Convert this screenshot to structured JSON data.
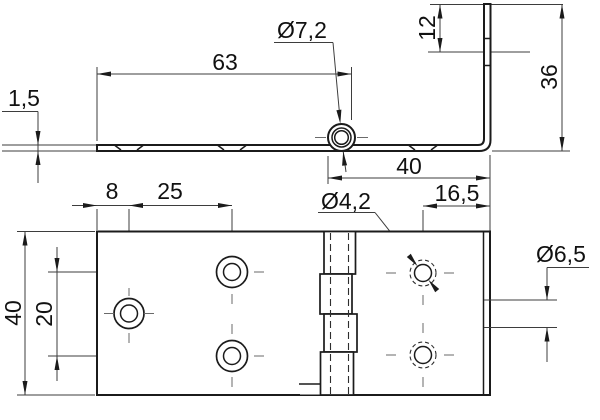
{
  "drawing": {
    "type": "technical-drawing",
    "part": "bent hinge, two views (side profile and plan view)",
    "units_style": "comma decimal",
    "labels": {
      "plate_thickness": "1,5",
      "left_leaf_length": "63",
      "knuckle_hole_dia": "Ø7,2",
      "flange_hole_offset": "12",
      "flange_height": "36",
      "right_leaf_length": "40",
      "hole_to_edge": "16,5",
      "edge_to_hole_col": "8",
      "hole_col_spacing": "25",
      "leaf_hole_dia": "Ø4,2",
      "flange_hole_dia": "Ø6,5",
      "hole_row_spacing": "20",
      "hinge_width": "40"
    },
    "colors": {
      "line": "#1b1b1b",
      "background": "#ffffff"
    }
  }
}
